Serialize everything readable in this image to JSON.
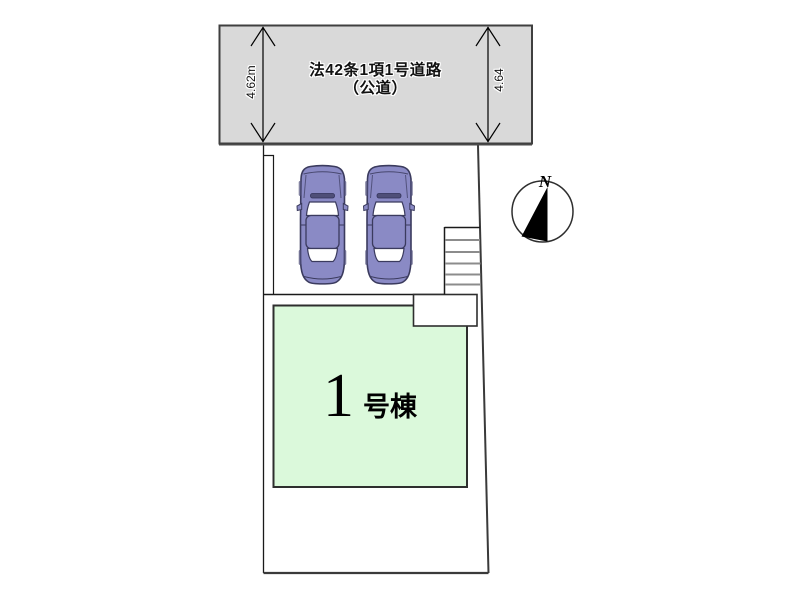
{
  "plan": {
    "road": {
      "name_line1": "法42条1項1号道路",
      "name_line2": "（公道）",
      "width_left": "4.62m",
      "width_right": "4.64",
      "fill_color": "#d9d9d9"
    },
    "building": {
      "number": "1",
      "unit_suffix": "号棟",
      "fill_color": "#dbf9db"
    },
    "cars": {
      "body_color": "#8a8ac5"
    },
    "compass": {
      "north_label": "N"
    },
    "icons": {
      "car": "car-top-view",
      "stairs": "staircase",
      "compass": "north-arrow"
    }
  }
}
